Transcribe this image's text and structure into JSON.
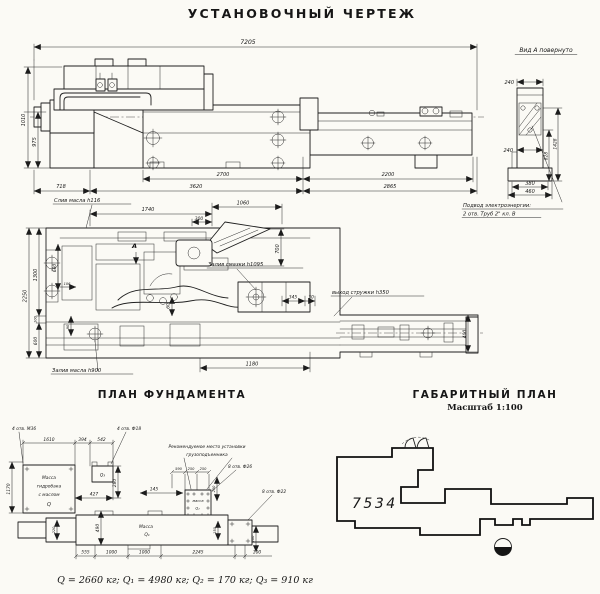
{
  "title": "УСТАНОВОЧНЫЙ ЧЕРТЕЖ",
  "side_view": {
    "dim_7205": "7205",
    "dim_1010": "1010",
    "dim_975": "975",
    "dim_718": "718",
    "dim_3620": "3620",
    "dim_2700": "2700",
    "dim_2200": "2200",
    "dim_2865": "2865"
  },
  "view_a": {
    "title": "Вид А повернуто",
    "dim_240_top": "240",
    "dim_240_mid": "240",
    "dim_828": "828",
    "dim_1428": "1428",
    "dim_380": "380",
    "dim_460": "460",
    "note_line1": "Подвод электроэнергии:",
    "note_line2": "2 отв. Труб 2\" кл. В"
  },
  "plan_view": {
    "label_oil_drain": "Слив масла h116",
    "label_grease_fill": "Залив смазки h1095",
    "label_chip_exit": "выход стружки h350",
    "label_oil_fill": "Залив масла h900",
    "label_view_a_arrow": "А",
    "dim_1740": "1740",
    "dim_300": "300",
    "dim_1060": "1060",
    "dim_700": "700",
    "dim_345": "345",
    "dim_30": "30",
    "dim_60": "60",
    "dim_2250": "2250",
    "dim_1300": "1300",
    "dim_680": "680",
    "dim_106": "106",
    "dim_100": "100",
    "dim_600": "600",
    "dim_90": "90",
    "dim_1180": "1180",
    "dim_400": "400"
  },
  "foundation_plan": {
    "title": "ПЛАН ФУНДАМЕНТА",
    "label_m36": "4 отв. М36",
    "label_f18": "4 отв. Ф18",
    "label_f26": "8 отв. Ф26",
    "label_f22": "8 отв. Ф22",
    "label_recommended_1": "Рекомендуемое место установки",
    "label_recommended_2": "грузоподъемника",
    "tank_line1": "Масса",
    "tank_line2": "гидробака",
    "tank_line3": "с маслом",
    "tank_line4": "Q",
    "q1_line1": "Масса",
    "q1_line2": "Q₁",
    "q2_line1": "масса",
    "q2_line2": "Q₂",
    "q3_label": "Q₃",
    "dim_1610": "1610",
    "dim_394": "394",
    "dim_542": "542",
    "dim_427": "427",
    "dim_280": "280",
    "dim_1170": "1170",
    "dim_590": "590",
    "dim_250a": "250",
    "dim_250b": "250",
    "dim_145": "145",
    "dim_250v": "250",
    "dim_220": "220",
    "dim_490": "490",
    "dim_555": "555",
    "dim_1000a": "1000",
    "dim_1000b": "1000",
    "dim_2245": "2245",
    "dim_100": "100",
    "dim_150": "150",
    "dim_200": "200"
  },
  "overall_plan": {
    "title": "ГАБАРИТНЫЙ ПЛАН",
    "scale": "Масштаб 1:100",
    "model": "7534"
  },
  "footer": {
    "masses": "Q = 2660 кг;  Q₁ = 4980 кг;  Q₂ = 170 кг;  Q₃ = 910 кг"
  }
}
